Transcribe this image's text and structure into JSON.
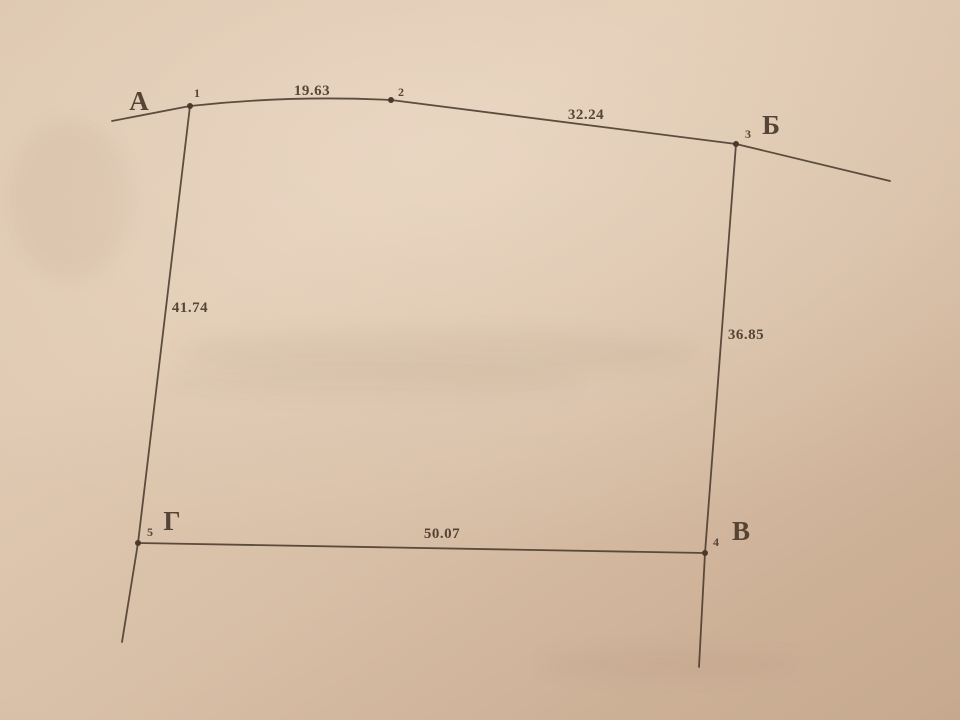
{
  "diagram": {
    "description": "Land-plot survey sketch (abris) photographed on paper: five numbered boundary points with measured side lengths",
    "colors": {
      "ink": "#4a3a2c",
      "paper": "#dbc3ac"
    },
    "corners": {
      "A": "А",
      "B": "Б",
      "V": "В",
      "G": "Г"
    },
    "points": {
      "p1": "1",
      "p2": "2",
      "p3": "3",
      "p4": "4",
      "p5": "5"
    },
    "distances": {
      "d_1_2": "19.63",
      "d_2_3": "32.24",
      "d_1_5": "41.74",
      "d_3_4": "36.85",
      "d_5_4": "50.07"
    },
    "edges": [
      {
        "from": "1",
        "to": "2",
        "length": 19.63
      },
      {
        "from": "2",
        "to": "3",
        "length": 32.24
      },
      {
        "from": "1",
        "to": "5",
        "length": 41.74
      },
      {
        "from": "3",
        "to": "4",
        "length": 36.85
      },
      {
        "from": "5",
        "to": "4",
        "length": 50.07
      }
    ]
  }
}
